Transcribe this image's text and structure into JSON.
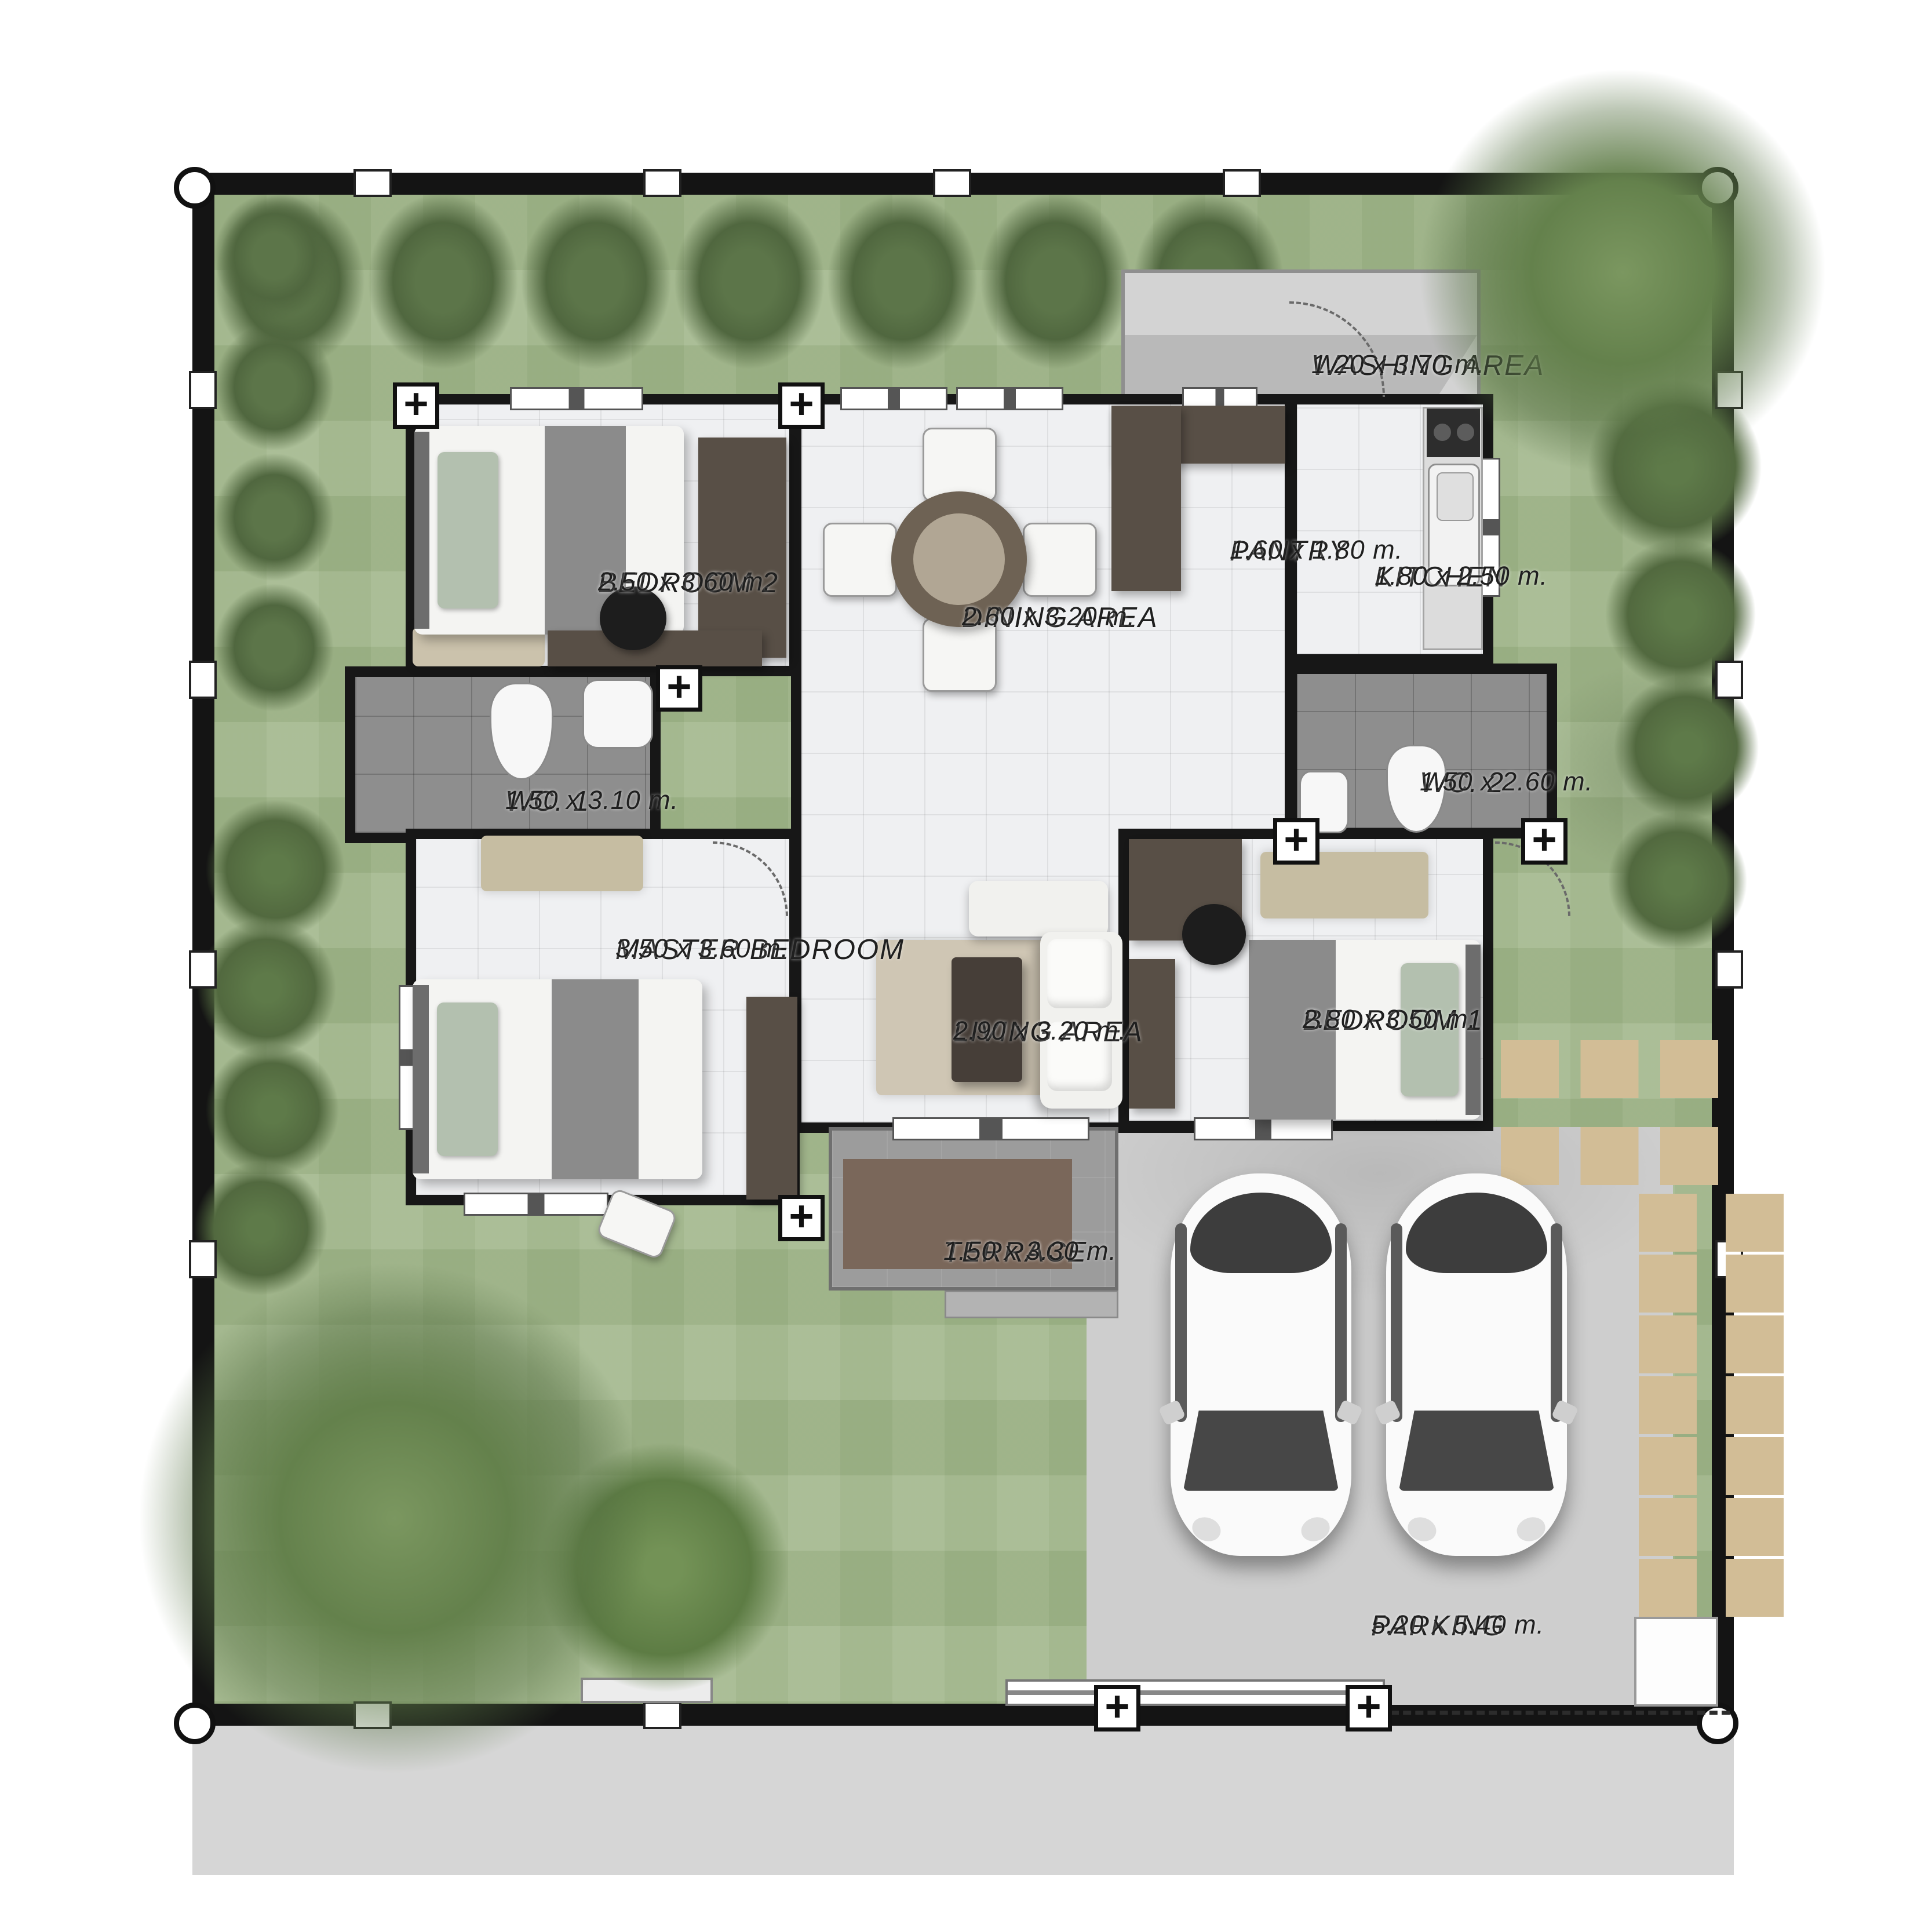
{
  "plan": {
    "type": "floor-plan",
    "rooms": [
      {
        "key": "washing-area",
        "name": "WASHING AREA",
        "dims": "1.20 x 3.70 m."
      },
      {
        "key": "bedroom-2",
        "name": "BEDROOM  2",
        "dims": "2.50 x 3.60 m."
      },
      {
        "key": "dining-area",
        "name": "DINING AREA",
        "dims": "2.60 x 3.20 m."
      },
      {
        "key": "pantry",
        "name": "PANTRY",
        "dims": "1.60 x 1.80 m."
      },
      {
        "key": "kitchen",
        "name": "KITCHEN",
        "dims": "1.80 x 2.50 m."
      },
      {
        "key": "wc-1",
        "name": "WC.  1",
        "dims": "1.50 x  3.10 m."
      },
      {
        "key": "wc-2",
        "name": "WC. 2",
        "dims": "1.50 x 2.60 m."
      },
      {
        "key": "master-bedroom",
        "name": "MASTER BEDROOM",
        "dims": "3.50 x 3.60 m."
      },
      {
        "key": "living-area",
        "name": "LIVING AREA",
        "dims": "2.90 x 3.20 m."
      },
      {
        "key": "bedroom-1",
        "name": "BEDROOM  1",
        "dims": "2.80 x 3.50 m."
      },
      {
        "key": "terrace",
        "name": "TERRACE",
        "dims": "1.50 x 3.30 m."
      },
      {
        "key": "parking",
        "name": "PARKING",
        "dims": "5.20 x 5.40 m."
      }
    ],
    "colors": {
      "lawn": "#a4b98e",
      "hedge": "#52693f",
      "fence": "#141414",
      "floor": "#eff0f2",
      "wc_floor": "#8e8e8e",
      "terrace_mat": "#7a675a",
      "parking_slab": "#cecece",
      "stepping_stone": "#d2bd96",
      "street": "#d6d6d6",
      "wood_furniture": "#584f46"
    }
  }
}
